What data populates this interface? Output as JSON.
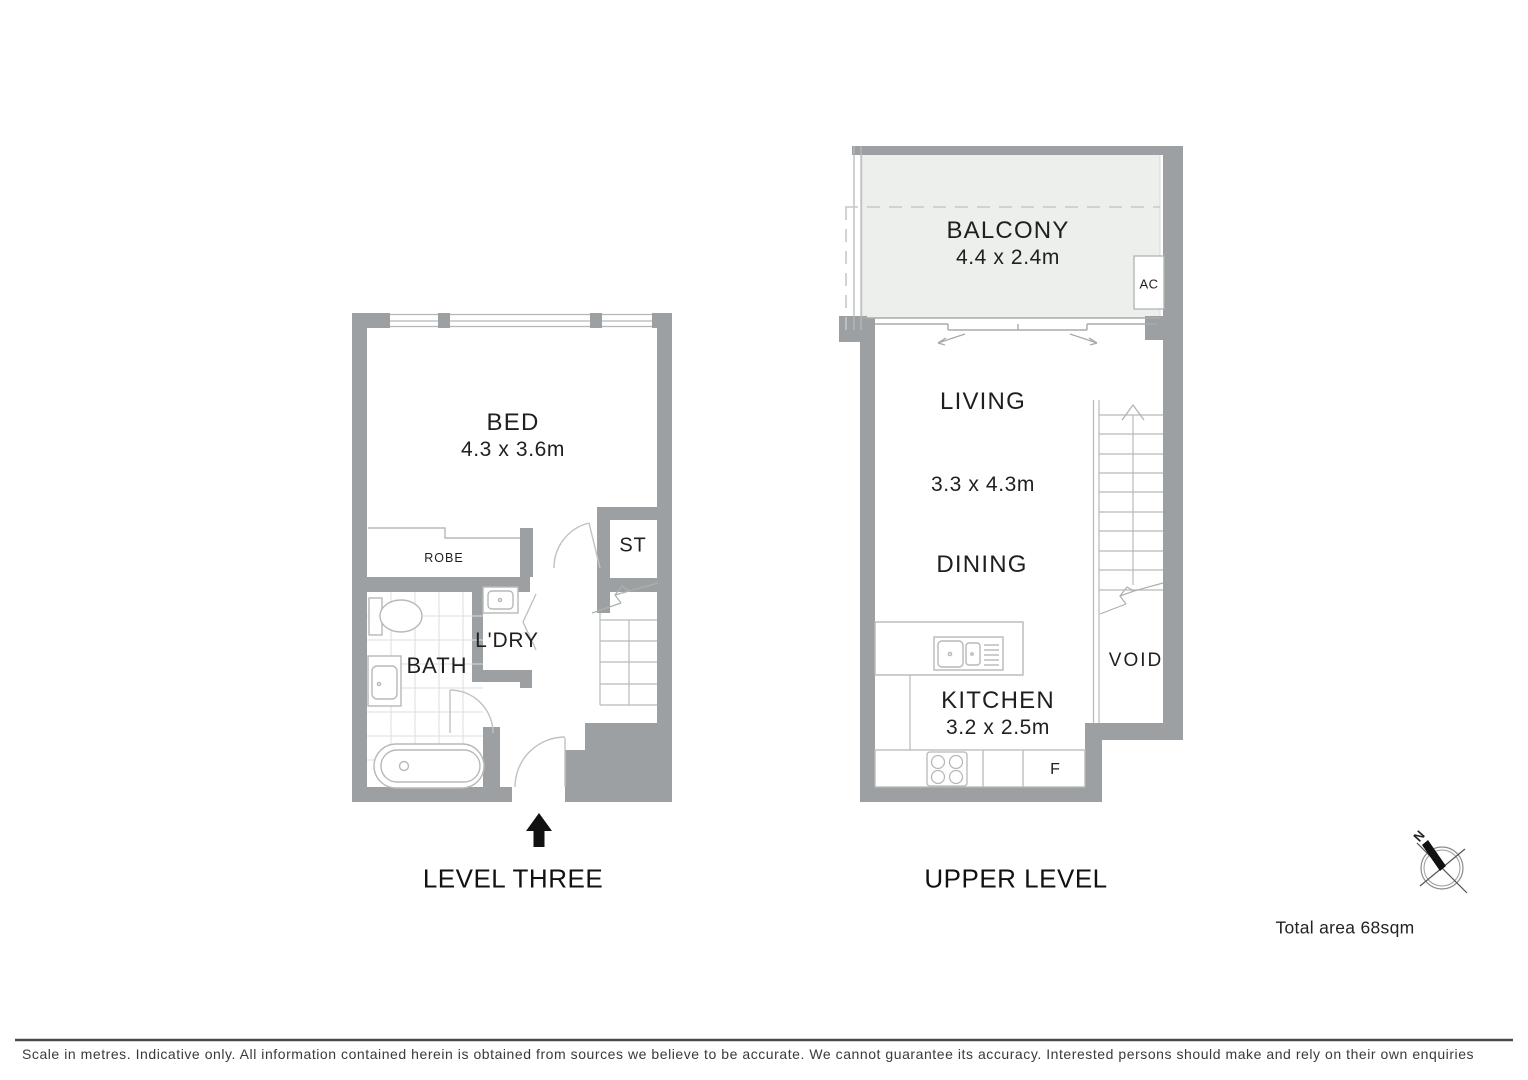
{
  "labels": {
    "level_three": {
      "title": "LEVEL THREE",
      "bed": "BED",
      "bed_dims": "4.3 x 3.6m",
      "robe": "ROBE",
      "storage": "ST",
      "laundry": "L'DRY",
      "bath": "BATH"
    },
    "upper_level": {
      "title": "UPPER LEVEL",
      "balcony": "BALCONY",
      "balcony_dims": "4.4 x 2.4m",
      "ac": "AC",
      "living": "LIVING",
      "living_dining_dims": "3.3 x 4.3m",
      "dining": "DINING",
      "kitchen": "KITCHEN",
      "kitchen_dims": "3.2 x 2.5m",
      "fridge": "F",
      "void": "VOID"
    },
    "compass_north": "N",
    "total_area": "Total area 68sqm",
    "disclaimer": "Scale in metres. Indicative only. All information contained herein is obtained from sources we believe to be accurate. We cannot guarantee its accuracy. Interested persons should make and rely on their own enquiries"
  },
  "colors": {
    "wall": "#9da0a2",
    "balcony_fill": "#ecefec",
    "fixture_line": "#b7b9b9",
    "tile_line": "#dcdedc",
    "text": "#1f1f1f",
    "entry_arrow": "#111111"
  }
}
